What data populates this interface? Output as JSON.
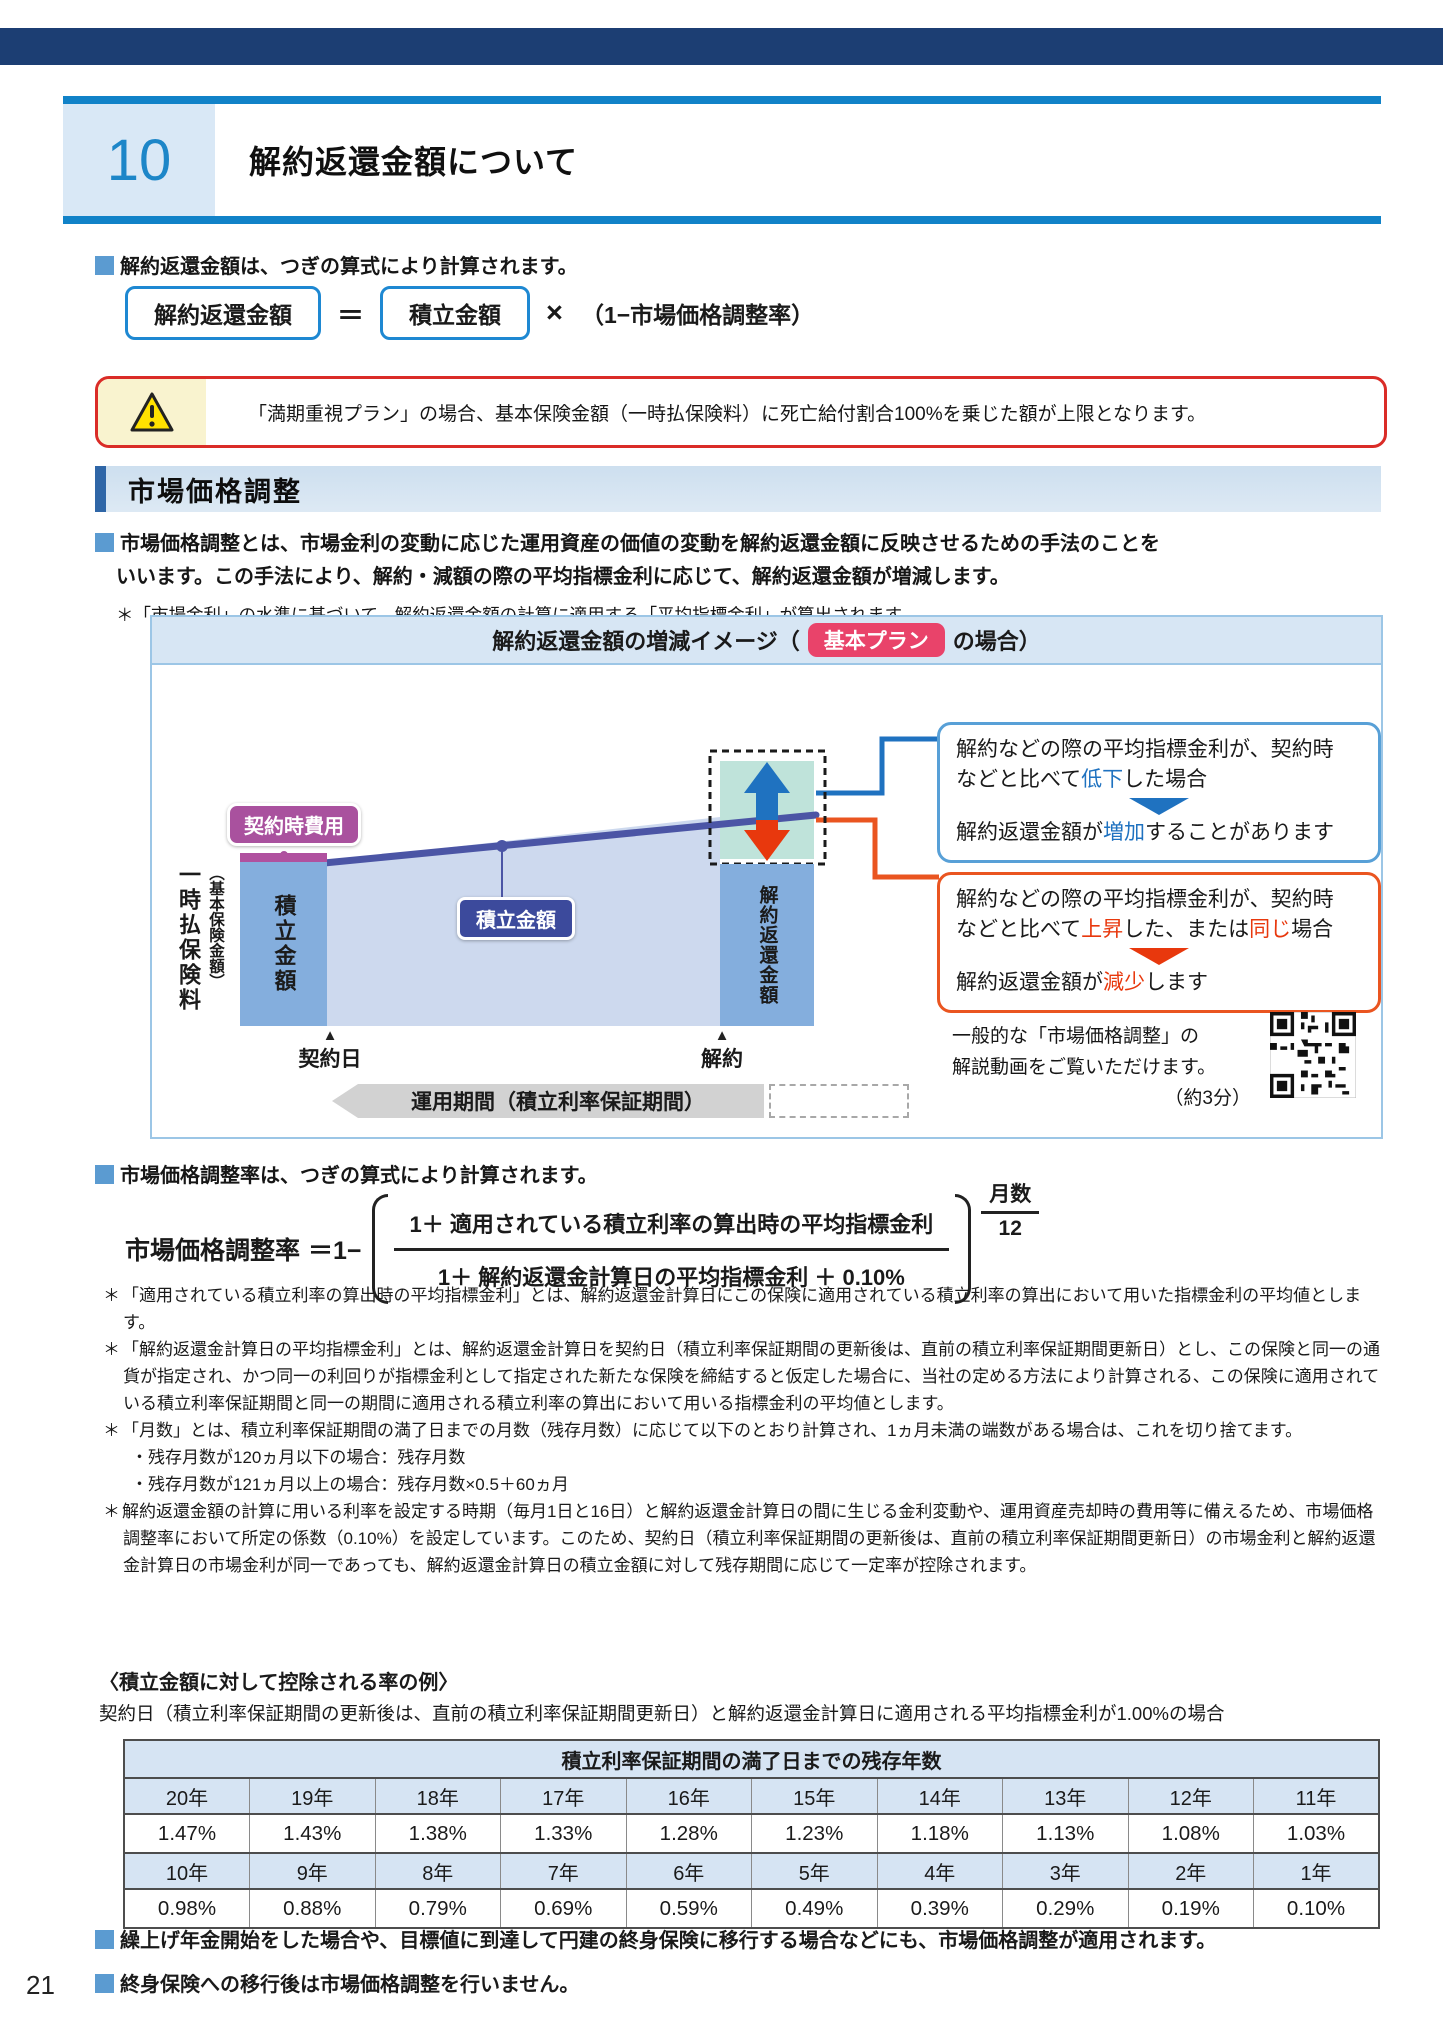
{
  "page_number": "21",
  "chapter": {
    "number": "10",
    "title": "解約返還金額について"
  },
  "intro": {
    "text": "解約返還金額は、つぎの算式により計算されます。"
  },
  "formula1": {
    "lhs": "解約返還金額",
    "eq": "＝",
    "rhs": "積立金額",
    "mult": "×",
    "tail": "（1−市場価格調整率）"
  },
  "warning": {
    "text": "「満期重視プラン」の場合、基本保険金額（一時払保険料）に死亡給付割合100%を乗じた額が上限となります。"
  },
  "mva_section": {
    "title": "市場価格調整",
    "intro_line1": "市場価格調整とは、市場金利の変動に応じた運用資産の価値の変動を解約返還金額に反映させるための手法のことを",
    "intro_line2": "いいます。この手法により、解約・減額の際の平均指標金利に応じて、解約返還金額が増減します。",
    "note": "＊「市場金利」の水準に基づいて、解約返還金額の計算に適用する「平均指標金利」が算出されます。"
  },
  "diagram": {
    "title_pre": "解約返還金額の増減イメージ（",
    "badge": "基本プラン",
    "title_post": "の場合）",
    "labels": {
      "contract_cost": "契約時費用",
      "premium": "一時払保険料",
      "premium_sub": "（基本保険金額）",
      "account_bar": "積立金額",
      "account_badge": "積立金額",
      "surrender_bar": "解約返還金額",
      "contract_tri": "▲",
      "contract_date": "契約日",
      "surrender_tri": "▲",
      "surrender_date": "解約",
      "period_band": "運用期間（積立利率保証期間）"
    },
    "callout_down": {
      "line1": "解約などの際の平均指標金利が、契約時",
      "line2_pre": "などと比べて",
      "line2_hl": "低下",
      "line2_post": "した場合",
      "result_pre": "解約返還金額が",
      "result_hl": "増加",
      "result_post": "することがあります"
    },
    "callout_up": {
      "line1": "解約などの際の平均指標金利が、契約時",
      "line2_pre": "などと比べて",
      "line2_hl1": "上昇",
      "line2_mid": "した、または",
      "line2_hl2": "同じ",
      "line2_post": "場合",
      "result_pre": "解約返還金額が",
      "result_hl": "減少",
      "result_post": "します"
    },
    "video_note": {
      "line1": "一般的な「市場価格調整」の",
      "line2": "解説動画をご覧いただけます。",
      "line3": "（約3分）"
    }
  },
  "rate_formula": {
    "intro": "市場価格調整率は、つぎの算式により計算されます。",
    "label": "市場価格調整率",
    "eq": "＝1−",
    "numerator": "1＋ 適用されている積立利率の算出時の平均指標金利",
    "denominator": "1＋ 解約返還金計算日の平均指標金利 ＋ 0.10%",
    "exp_num": "月数",
    "exp_den": "12"
  },
  "notes": [
    {
      "marker": "＊",
      "text": "「適用されている積立利率の算出時の平均指標金利」とは、解約返還金計算日にこの保険に適用されている積立利率の算出において用いた指標金利の平均値とします。"
    },
    {
      "marker": "＊",
      "text": "「解約返還金計算日の平均指標金利」とは、解約返還金計算日を契約日（積立利率保証期間の更新後は、直前の積立利率保証期間更新日）とし、この保険と同一の通貨が指定され、かつ同一の利回りが指標金利として指定された新たな保険を締結すると仮定した場合に、当社の定める方法により計算される、この保険に適用されている積立利率保証期間と同一の期間に適用される積立利率の算出において用いる指標金利の平均値とします。"
    },
    {
      "marker": "＊",
      "text": "「月数」とは、積立利率保証期間の満了日までの月数（残存月数）に応じて以下のとおり計算され、1ヵ月未満の端数がある場合は、これを切り捨てます。",
      "sub": [
        "・残存月数が120ヵ月以下の場合：残存月数",
        "・残存月数が121ヵ月以上の場合：残存月数×0.5＋60ヵ月"
      ]
    },
    {
      "marker": "＊",
      "text": "解約返還金額の計算に用いる利率を設定する時期（毎月1日と16日）と解約返還金計算日の間に生じる金利変動や、運用資産売却時の費用等に備えるため、市場価格調整率において所定の係数（0.10%）を設定しています。このため、契約日（積立利率保証期間の更新後は、直前の積立利率保証期間更新日）の市場金利と解約返還金計算日の市場金利が同一であっても、解約返還金計算日の積立金額に対して残存期間に応じて一定率が控除されます。"
    }
  ],
  "example": {
    "heading": "〈積立金額に対して控除される率の例〉",
    "description": "契約日（積立利率保証期間の更新後は、直前の積立利率保証期間更新日）と解約返還金計算日に適用される平均指標金利が1.00%の場合"
  },
  "rate_table": {
    "title": "積立利率保証期間の満了日までの残存年数",
    "years_row1": [
      "20年",
      "19年",
      "18年",
      "17年",
      "16年",
      "15年",
      "14年",
      "13年",
      "12年",
      "11年"
    ],
    "rates_row1": [
      "1.47%",
      "1.43%",
      "1.38%",
      "1.33%",
      "1.28%",
      "1.23%",
      "1.18%",
      "1.13%",
      "1.08%",
      "1.03%"
    ],
    "years_row2": [
      "10年",
      "9年",
      "8年",
      "7年",
      "6年",
      "5年",
      "4年",
      "3年",
      "2年",
      "1年"
    ],
    "rates_row2": [
      "0.98%",
      "0.88%",
      "0.79%",
      "0.69%",
      "0.59%",
      "0.49%",
      "0.39%",
      "0.29%",
      "0.19%",
      "0.10%"
    ]
  },
  "footer_notes": [
    "繰上げ年金開始をした場合や、目標値に到達して円建の終身保険に移行する場合などにも、市場価格調整が適用されます。",
    "終身保険への移行後は市場価格調整を行いません。"
  ]
}
